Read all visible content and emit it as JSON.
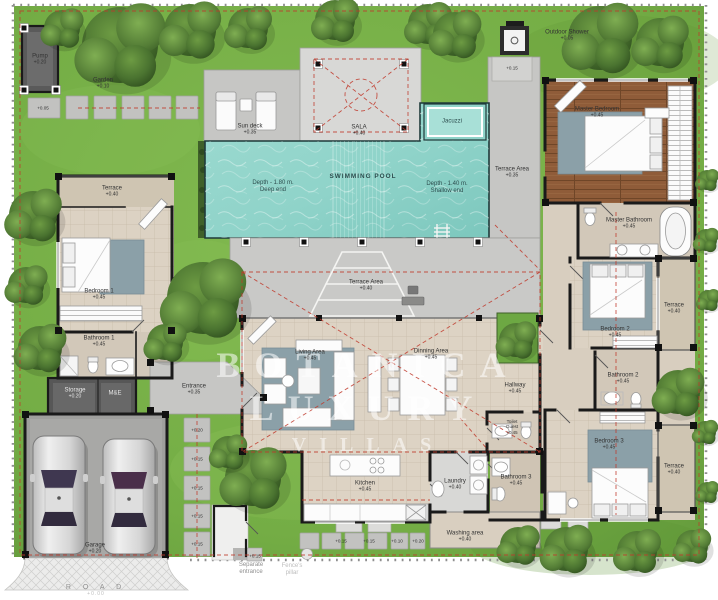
{
  "watermark": {
    "line1": "BOTANICA",
    "line2": "LUXURY",
    "line3": "VILLAS"
  },
  "site": {
    "garden": {
      "name": "Garden",
      "level": "+0.10"
    },
    "road": {
      "name": "R O A D",
      "level": "+0.00"
    },
    "separate_entrance": {
      "line1": "Separate",
      "line2": "entrance"
    },
    "fence_note": {
      "line1": "Fence's",
      "line2": "pillar"
    },
    "stone_levels": {
      "start": "+0.05",
      "v1": "+0.20",
      "v2": "+0.15",
      "v3": "+0.15",
      "v4": "+0.15",
      "v5": "+0.15",
      "b1": "+0.15",
      "b2": "+0.15",
      "b3": "+0.10",
      "b4": "+0.20",
      "sep_pad": "+0.15",
      "shower_pad": "+0.15"
    }
  },
  "rooms": {
    "pump": {
      "name": "Pump",
      "level": "+0.20"
    },
    "sun_deck": {
      "name": "Sun deck",
      "level": "+0.35"
    },
    "sala": {
      "name": "SALA",
      "level": "+0.40"
    },
    "pool": {
      "name": "SWIMMING POOL",
      "deep_line1": "Depth - 1.80 m.",
      "deep_line2": "Deep end",
      "shallow_line1": "Depth - 1.40 m.",
      "shallow_line2": "Shallow end"
    },
    "jacuzzi": {
      "name": "Jacuzzi"
    },
    "pool_terrace": {
      "name": "Terrace Area",
      "level": "+0.35"
    },
    "outdoor_shower": {
      "name": "Outdoor Shower",
      "level": "+0.05"
    },
    "master_bedroom": {
      "name": "Master Bedroom",
      "level": "+0.45"
    },
    "master_bathroom": {
      "name": "Master Bathroom",
      "level": "+0.45"
    },
    "terrace_bedroom2": {
      "name": "Terrace",
      "level": "+0.40"
    },
    "bedroom2": {
      "name": "Bedroom 2",
      "level": "+0.45"
    },
    "bathroom2": {
      "name": "Bathroom 2",
      "level": "+0.45"
    },
    "hallway": {
      "name": "Hallway",
      "level": "+0.45"
    },
    "toilet_guest": {
      "line1": "Toilet",
      "line2": "Guest",
      "level": "+0.45"
    },
    "bathroom3": {
      "name": "Bathroom 3",
      "level": "+0.45"
    },
    "bedroom3": {
      "name": "Bedroom 3",
      "level": "+0.45"
    },
    "terrace_bedroom3": {
      "name": "Terrace",
      "level": "+0.40"
    },
    "center_terrace": {
      "name": "Terrace Area",
      "level": "+0.40"
    },
    "living": {
      "name": "Living Area",
      "level": "+0.45"
    },
    "dining": {
      "name": "Dinning Area",
      "level": "+0.45"
    },
    "terrace_bedroom1": {
      "name": "Terrace",
      "level": "+0.40"
    },
    "bedroom1": {
      "name": "Bedroom 1",
      "level": "+0.45"
    },
    "bathroom1": {
      "name": "Bathroom 1",
      "level": "+0.45"
    },
    "storage": {
      "name": "Storage",
      "level": "+0.20"
    },
    "me_room": {
      "name": "M&E"
    },
    "entrance": {
      "name": "Entrance",
      "level": "+0.35"
    },
    "kitchen": {
      "name": "Kitchen",
      "level": "+0.45"
    },
    "laundry": {
      "name": "Laundry",
      "level": "+0.40"
    },
    "washing": {
      "name": "Washing area",
      "level": "+0.40"
    },
    "garage": {
      "name": "Garage",
      "level": "+0.20"
    }
  },
  "colors": {
    "grass": "#74ad45",
    "pool": "#8fd3c9",
    "deck": "#c9c9c7",
    "wood": "#8f5c39",
    "wall": "#1a1a1a",
    "boundary_red": "#c0392b",
    "tile": "#ddd3c4",
    "rug": "#8ba0a8"
  }
}
